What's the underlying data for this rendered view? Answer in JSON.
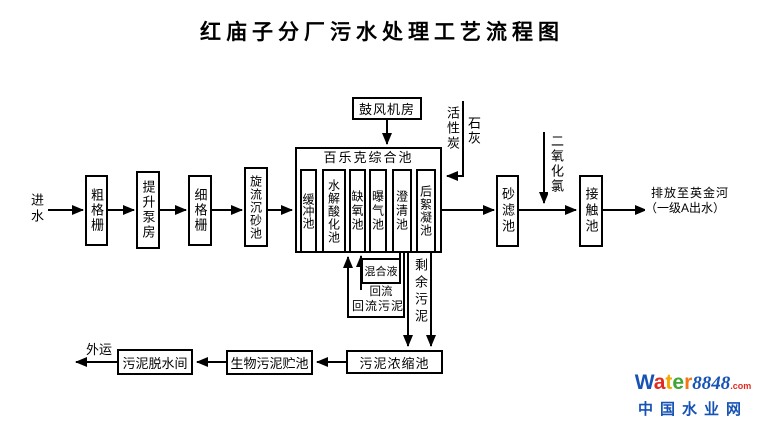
{
  "title": "红庙子分厂污水处理工艺流程图",
  "flow": {
    "inlet": "进水",
    "coarse_screen": "粗格栅",
    "lift_pump": "提升泵房",
    "fine_screen": "细格栅",
    "grit_chamber": "旋流沉砂池",
    "sand_filter": "砂滤池",
    "contact_tank": "接触池",
    "discharge_line1": "排放至英金河",
    "discharge_line2": "（一级A出水）"
  },
  "pool": {
    "title": "百乐克综合池",
    "cells": [
      "缓冲池",
      "水解酸化池",
      "缺氧池",
      "曝气池",
      "澄清池",
      "后絮凝池"
    ]
  },
  "aux": {
    "blower": "鼓风机房",
    "activated_carbon": "活性炭",
    "lime": "石灰",
    "chlorine_dioxide": "二氧化氯"
  },
  "returns": {
    "mixed_liquor": "混合液",
    "reflux": "回流",
    "return_sludge": "回流污泥",
    "excess_sludge": "剩余污泥"
  },
  "sludge": {
    "thickener": "污泥浓缩池",
    "bio_storage": "生物污泥贮池",
    "dewatering": "污泥脱水间",
    "outbound": "外运"
  },
  "logo": {
    "letters": [
      {
        "ch": "W",
        "color": "#1753b5"
      },
      {
        "ch": "a",
        "color": "#e02b20"
      },
      {
        "ch": "t",
        "color": "#f5a700"
      },
      {
        "ch": "e",
        "color": "#3fa535"
      },
      {
        "ch": "r",
        "color": "#f07818"
      }
    ],
    "number": "8848",
    "domain_suffix": ".com",
    "subtitle": "中国水业网",
    "blue": "#1753b5",
    "red": "#e02b20"
  }
}
